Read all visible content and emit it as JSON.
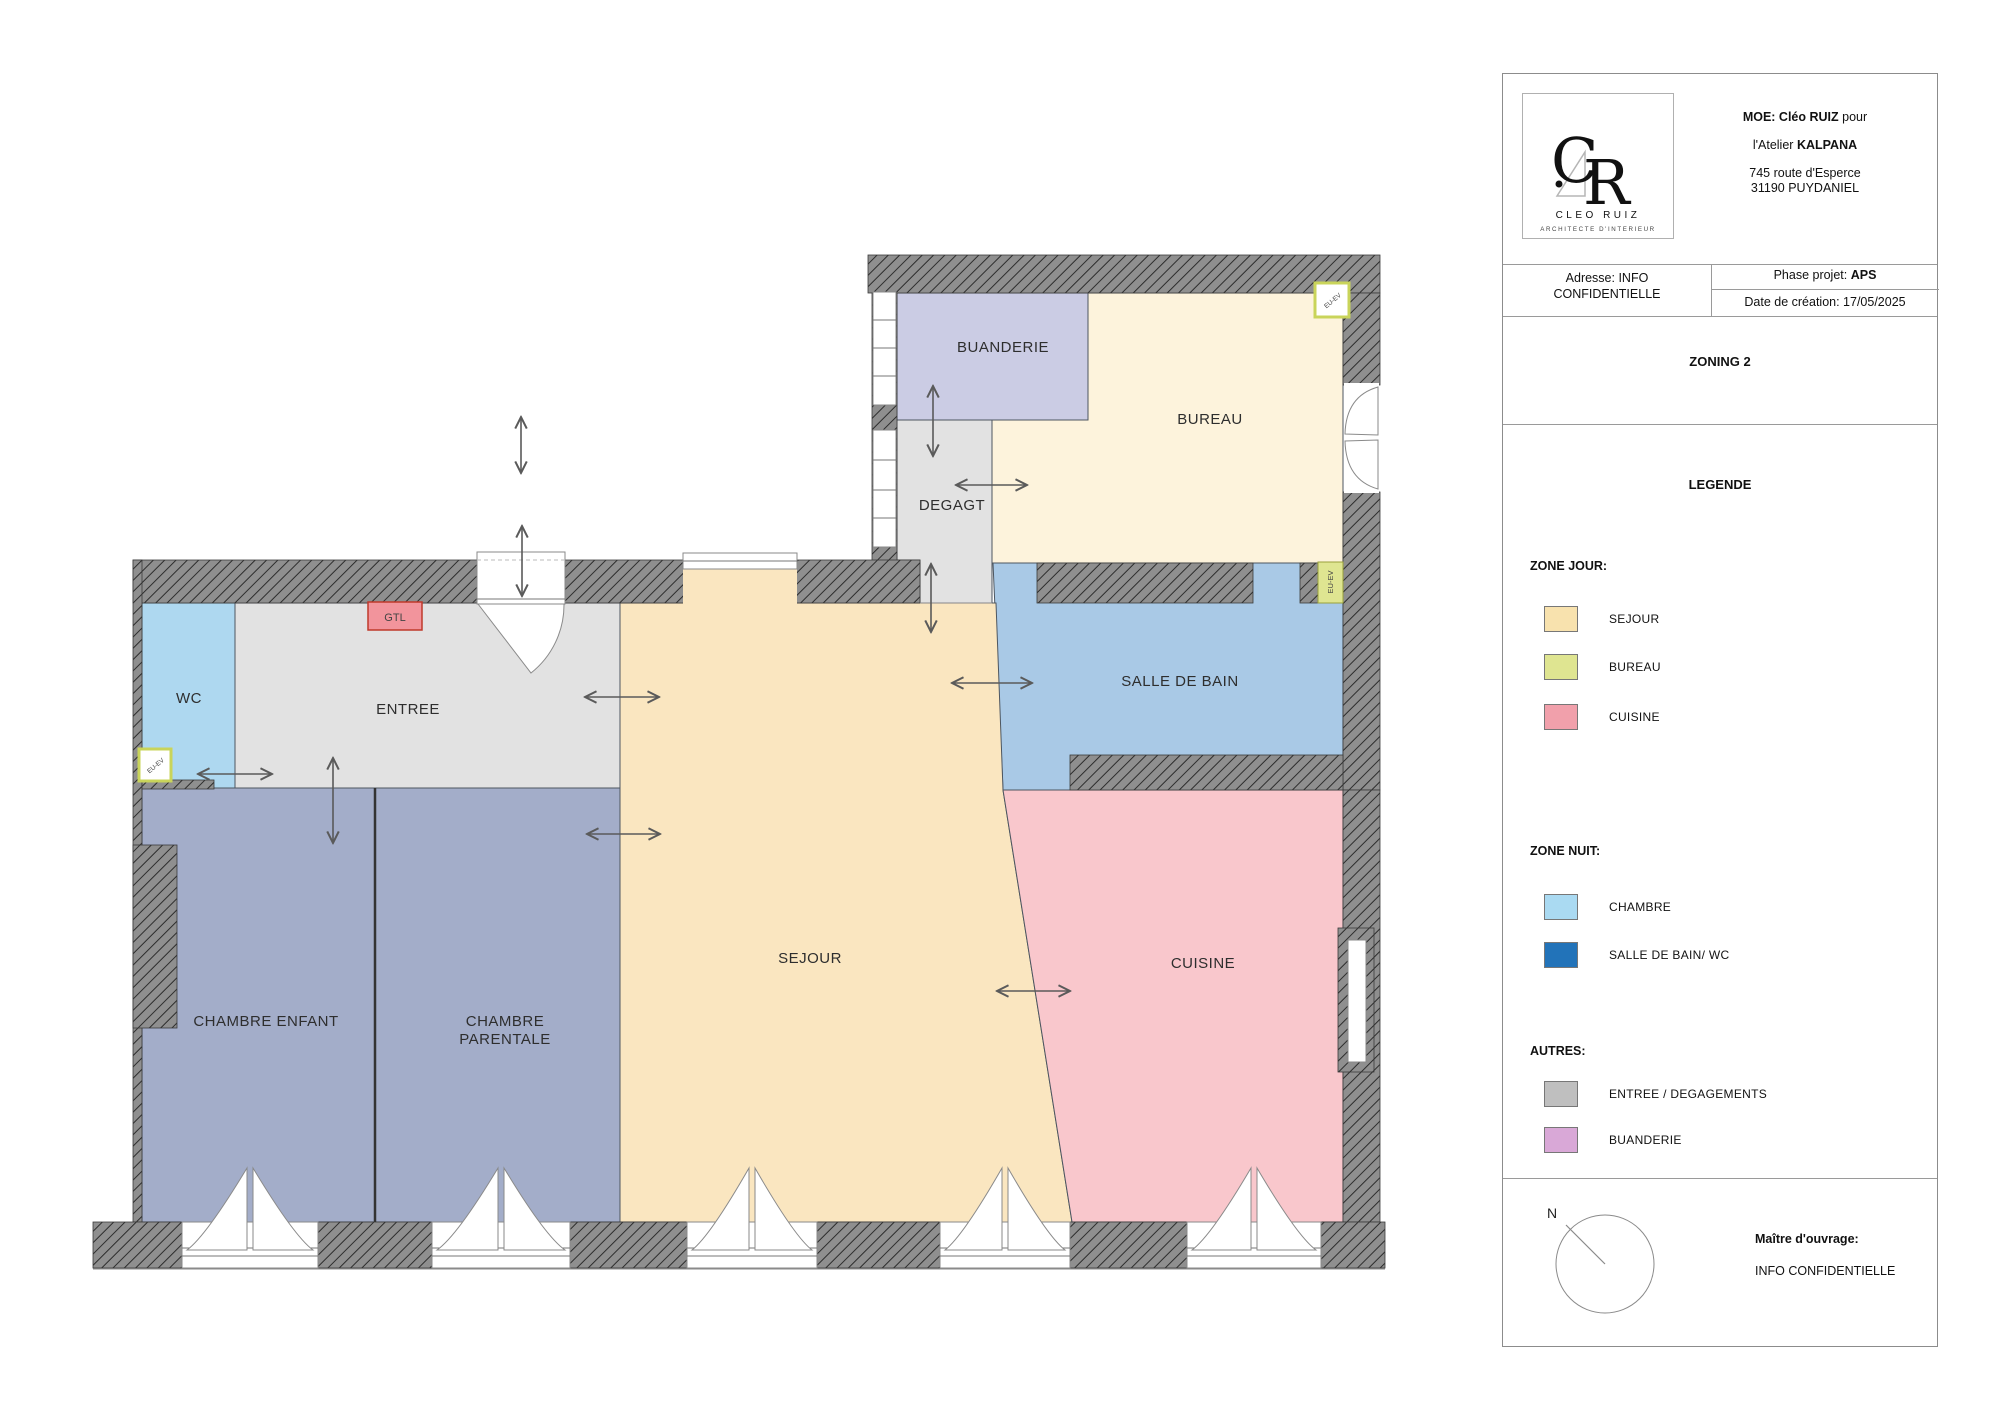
{
  "colors": {
    "rooms": {
      "buanderie": "#cbcce4",
      "bureau": "#fdf3dc",
      "degagement": "#e2e2e2",
      "salle_de_bain": "#a9c9e6",
      "wc": "#aed8f0",
      "sejour": "#fae6c0",
      "cuisine": "#f9c7cc",
      "chambre": "#a3adc9"
    },
    "legend": {
      "sejour": "#f8e2ae",
      "bureau": "#dfe591",
      "cuisine": "#f1a0ab",
      "chambre": "#aadaf2",
      "sdb_wc": "#2273b9",
      "entree_degagements": "#bfbfbf",
      "buanderie": "#d9a8d7"
    },
    "gtl_fill": "#f2949c",
    "eu_ev_fill": "#dfe591"
  },
  "plan": {
    "rooms": {
      "buanderie": "BUANDERIE",
      "bureau": "BUREAU",
      "degagt": "DEGAGT",
      "salle_de_bain": "SALLE DE BAIN",
      "wc": "WC",
      "entree": "ENTREE",
      "sejour": "SEJOUR",
      "cuisine": "CUISINE",
      "chambre_enfant": "CHAMBRE ENFANT",
      "chambre_parentale_l1": "CHAMBRE",
      "chambre_parentale_l2": "PARENTALE"
    },
    "labels": {
      "gtl": "GTL",
      "eu_ev": "EU-EV"
    }
  },
  "title_block": {
    "logo": {
      "c": "C",
      "r": "R",
      "name": "CLEO RUIZ",
      "subtitle": "ARCHITECTE D'INTERIEUR"
    },
    "header": {
      "moe_bold": "MOE: Cléo RUIZ",
      "moe_suffix": " pour",
      "atelier_prefix": "l'Atelier ",
      "atelier_bold": "KALPANA",
      "address_line1": "745 route d'Esperce",
      "address_line2": "31190 PUYDANIEL"
    },
    "info": {
      "adresse_line1": "Adresse: INFO",
      "adresse_line2": "CONFIDENTIELLE",
      "phase_label": "Phase projet: ",
      "phase_value": "APS",
      "date": "Date de création: 17/05/2025"
    },
    "zoning_title": "ZONING 2",
    "legend": {
      "title": "LEGENDE",
      "zone_jour": {
        "title": "ZONE JOUR:",
        "items": [
          {
            "label": "SEJOUR"
          },
          {
            "label": "BUREAU"
          },
          {
            "label": "CUISINE"
          }
        ]
      },
      "zone_nuit": {
        "title": "ZONE NUIT:",
        "items": [
          {
            "label": "CHAMBRE"
          },
          {
            "label": "SALLE DE BAIN/ WC"
          }
        ]
      },
      "autres": {
        "title": "AUTRES:",
        "items": [
          {
            "label": "ENTREE / DEGAGEMENTS"
          },
          {
            "label": "BUANDERIE"
          }
        ]
      }
    },
    "compass_n": "N",
    "client": {
      "label": "Maître d'ouvrage:",
      "value": "INFO CONFIDENTIELLE"
    }
  }
}
